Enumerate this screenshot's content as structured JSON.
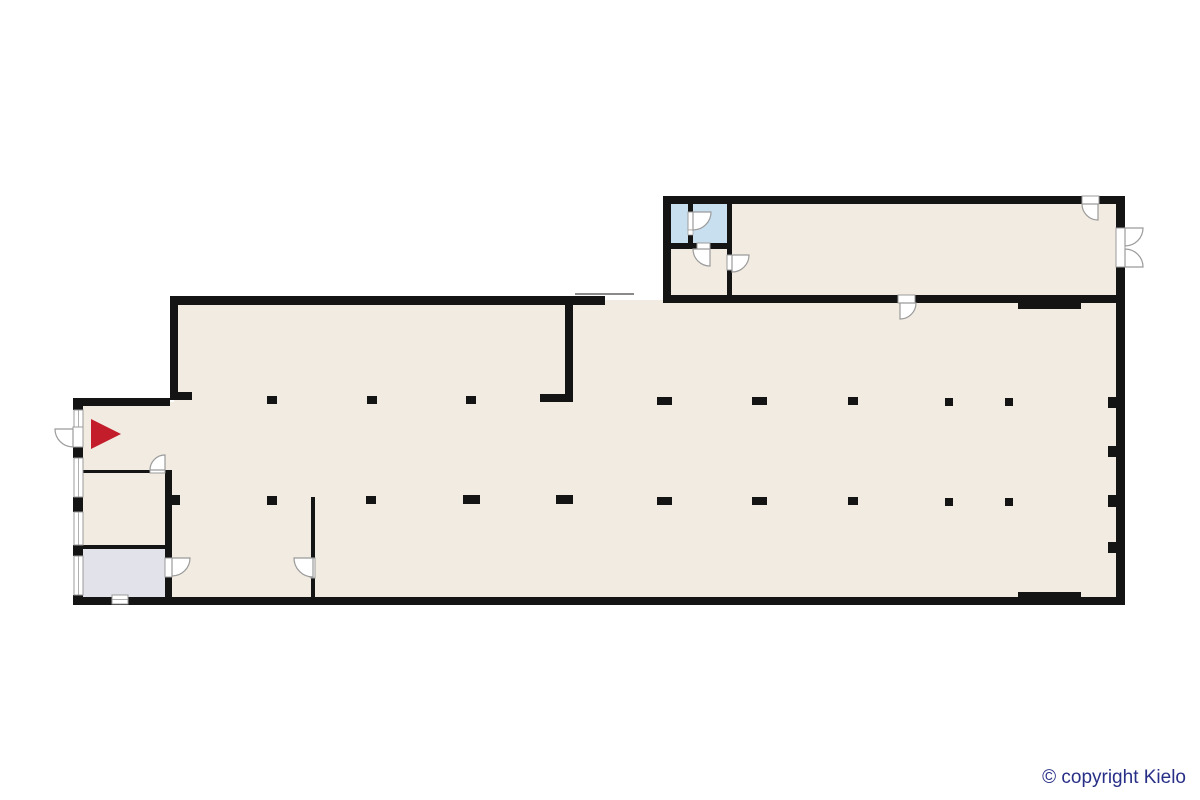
{
  "canvas": {
    "width": 1200,
    "height": 800,
    "background": "#ffffff"
  },
  "copyright": {
    "text": "© copyright Kielo",
    "color": "#282f87"
  },
  "palette": {
    "wall": "#141414",
    "floor": "#f1ebe1",
    "wetRoom": "#c8dff0",
    "utility": "#e2e2ea",
    "doorLine": "#9b9b9b",
    "thinLine": "#8a8a8a",
    "marker": "#c31c2b"
  },
  "marker": {
    "shape": "triangle",
    "direction": "right"
  },
  "columns": {
    "row1": [
      [
        267,
        396,
        10,
        8
      ],
      [
        367,
        396,
        10,
        8
      ],
      [
        466,
        396,
        10,
        8
      ],
      [
        657,
        397,
        15,
        8
      ],
      [
        752,
        397,
        15,
        8
      ],
      [
        848,
        397,
        10,
        8
      ],
      [
        945,
        398,
        8,
        8
      ],
      [
        1005,
        398,
        8,
        8
      ]
    ],
    "row2": [
      [
        172,
        495,
        8,
        10
      ],
      [
        267,
        496,
        10,
        9
      ],
      [
        366,
        496,
        10,
        8
      ],
      [
        463,
        495,
        17,
        9
      ],
      [
        556,
        495,
        17,
        9
      ],
      [
        657,
        497,
        15,
        8
      ],
      [
        752,
        497,
        15,
        8
      ],
      [
        848,
        497,
        10,
        8
      ],
      [
        945,
        498,
        8,
        8
      ],
      [
        1005,
        498,
        8,
        8
      ]
    ],
    "pilasters": [
      [
        1108,
        397,
        8,
        11
      ],
      [
        1108,
        446,
        8,
        11
      ],
      [
        1108,
        495,
        8,
        12
      ],
      [
        1108,
        542,
        8,
        11
      ]
    ]
  }
}
